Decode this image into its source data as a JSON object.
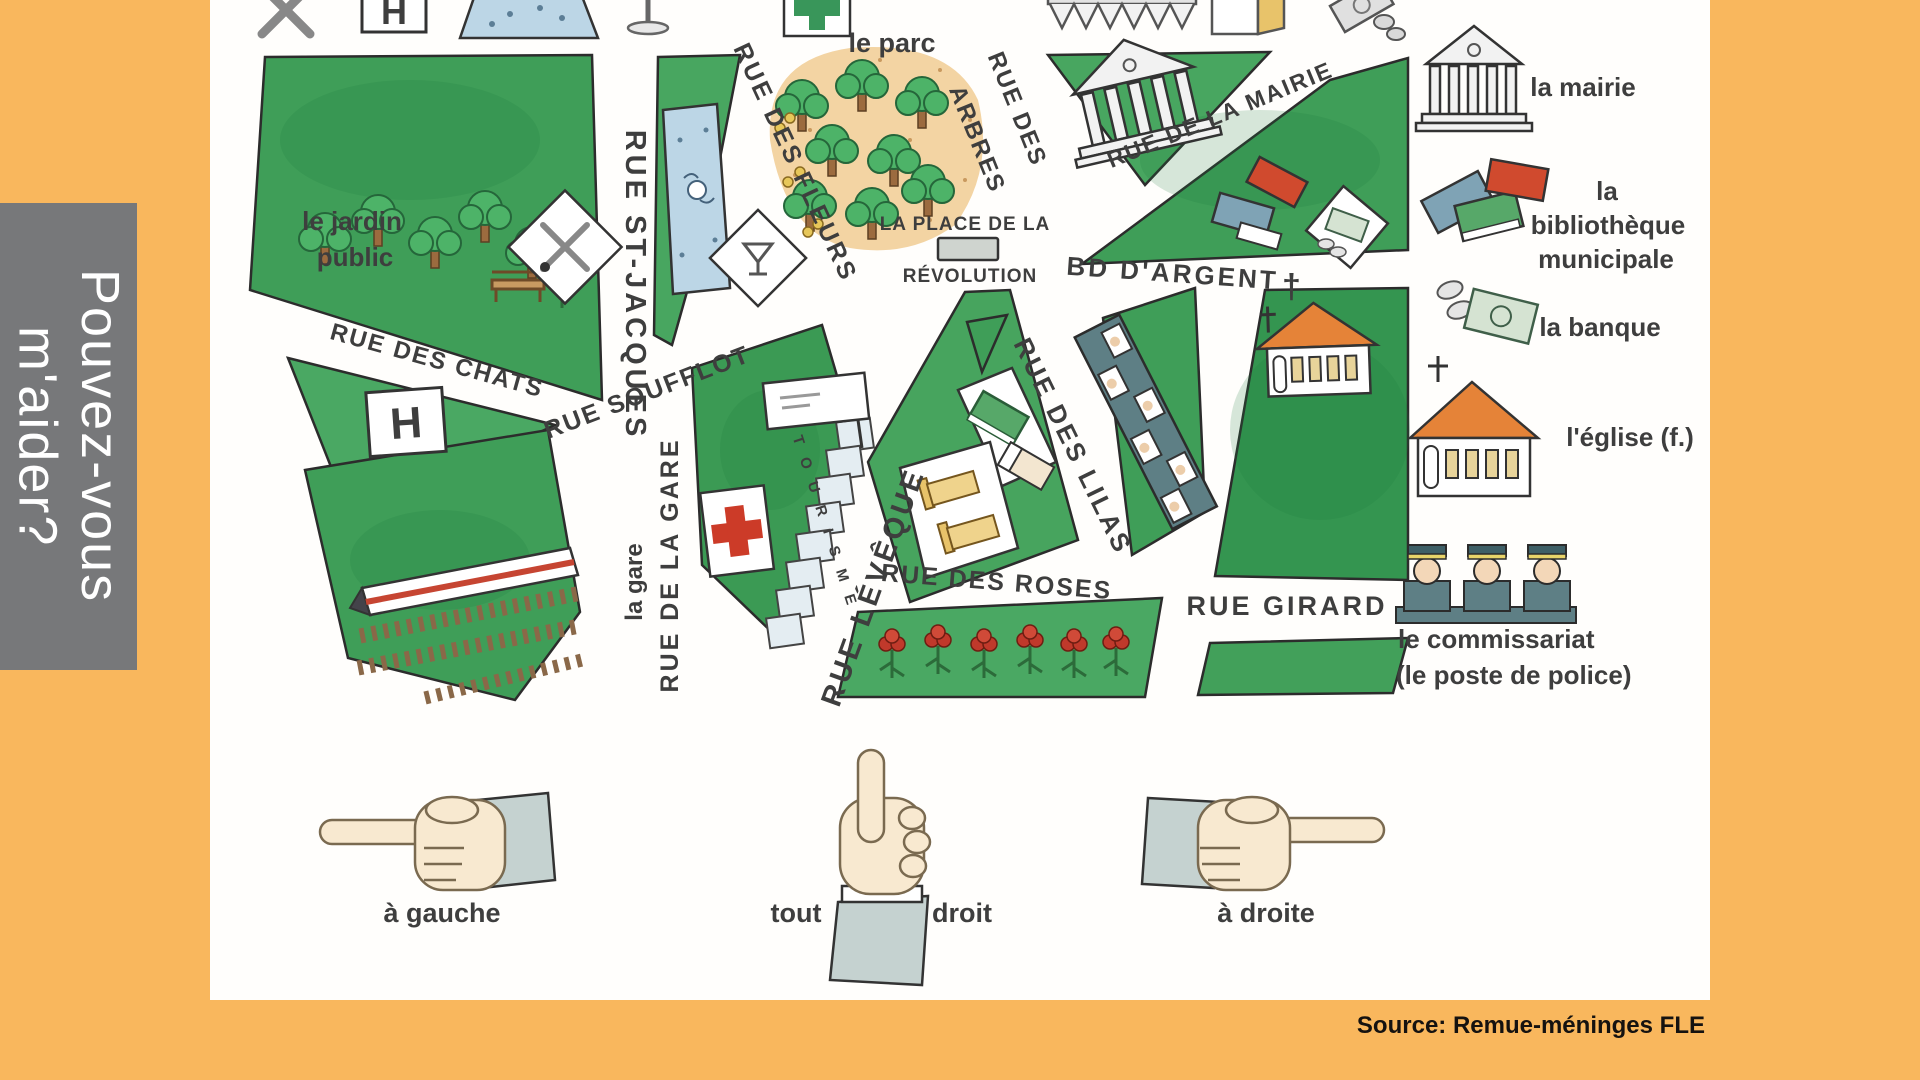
{
  "sidebar": {
    "line1": "Pouvez-vous",
    "line2": "m'aider?"
  },
  "map": {
    "labels": {
      "jardin1": "le jardin",
      "jardin2": "public",
      "parc": "le parc",
      "gare": "la gare",
      "place1": "LA PLACE DE LA",
      "place2": "RÉVOLUTION",
      "tourisme": "TOURISME",
      "h": "H"
    },
    "streets": {
      "st_jacques": "RUE ST-JACQUES",
      "chats": "RUE DES CHATS",
      "soufflot": "RUE SOUFFLOT",
      "fleurs": "RUE DES FLEURS",
      "arbres1": "RUE DES",
      "arbres2": "ARBRES",
      "mairie": "RUE DE LA MAIRIE",
      "argent": "BD D'ARGENT",
      "argent_cross": "†",
      "lilas": "RUE DES LILAS",
      "gare_st": "RUE DE LA GARE",
      "leveque": "RUE LÉVÊQUE",
      "roses": "RUE DES ROSES",
      "girard": "RUE GIRARD"
    },
    "legend": {
      "mairie": "la mairie",
      "bibliotheque": [
        "la",
        "bibliothèque",
        "municipale"
      ],
      "banque": "la banque",
      "eglise": "l'église (f.)",
      "commissariat": [
        "le commissariat",
        "(le poste de police)"
      ]
    },
    "directions": {
      "left": "à gauche",
      "straight_left": "tout",
      "straight_right": "droit",
      "right": "à droite"
    },
    "top_icons": [
      "restaurant",
      "hotel-h",
      "swimming-pool",
      "street-lamp",
      "pharmacy",
      "market",
      "kiosk",
      "money"
    ],
    "map_icons": [
      "restaurant",
      "hotel-h",
      "swimming-pool",
      "cocktail-bar",
      "pharmacy-cross",
      "tourist-office",
      "train-station",
      "monument",
      "town-hall",
      "library-books",
      "bank-money",
      "market-stalls",
      "church",
      "hotel-beds",
      "roses",
      "trees",
      "bench"
    ]
  },
  "source": "Source: Remue-méninges FLE",
  "colors": {
    "background_orange": "#f9b75d",
    "banner_gray": "#77787a",
    "map_green": "#3f9e58",
    "street_text": "#3e3e3e",
    "pharmacy_red": "#cc3b28",
    "roof_orange": "#e58338",
    "pool_blue": "#bcd6e6",
    "park_tan": "#f3d4a3",
    "police_teal": "#5e7f85",
    "bed_yellow": "#efd38c"
  }
}
